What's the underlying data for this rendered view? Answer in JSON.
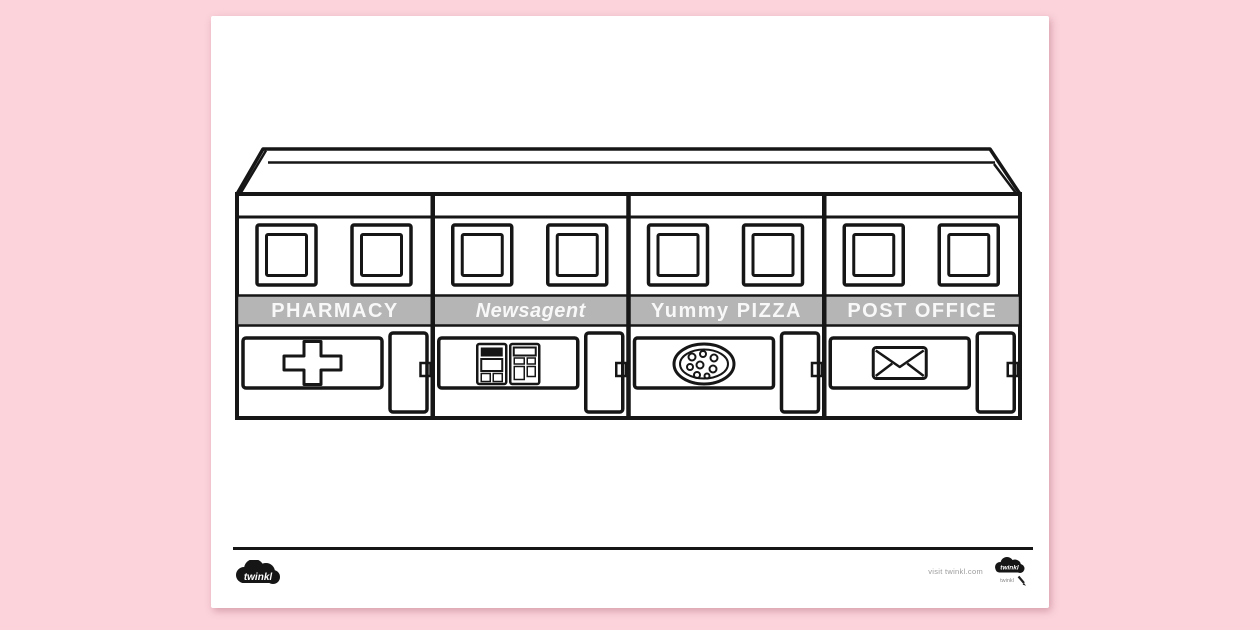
{
  "document": {
    "type": "shops-colouring-page"
  },
  "shops": [
    {
      "name": "PHARMACY",
      "icon": "medical-cross-icon"
    },
    {
      "name": "Newsagent",
      "icon": "newsstand-icon"
    },
    {
      "name": "Yummy PIZZA",
      "icon": "pizza-icon"
    },
    {
      "name": "POST OFFICE",
      "icon": "envelope-icon"
    }
  ],
  "footer": {
    "brand": "twinkl",
    "visit_text": "visit twinkl.com",
    "brand_small": "twinkl"
  },
  "colors": {
    "background": "#fcd3db",
    "paper": "#ffffff",
    "line": "#161616",
    "sign_band": "#b5b5b5",
    "sign_text": "#f8f8f8",
    "footer_text": "#9a9a9a"
  }
}
